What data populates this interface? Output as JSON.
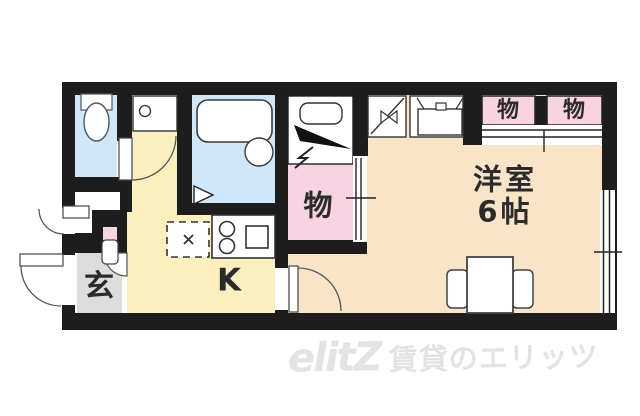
{
  "title": "apartment-floor-plan",
  "labels": {
    "genkan": "玄",
    "kitchen": "K",
    "closet": "物",
    "storage_top_1": "物",
    "storage_top_2": "物",
    "room_name": "洋室",
    "room_size": "6帖"
  },
  "watermark": {
    "logo": "elitZ",
    "text": "賃貸のエリッツ"
  },
  "colors": {
    "wall": "#1d1d1d",
    "water_blue": "#cfe7f8",
    "kitchen_yellow": "#fcefbe",
    "room_cream": "#f9e4c8",
    "storage_pink": "#f8d3e2",
    "entrance_gray": "#dcdcdc",
    "watermark_gray": "#e3e3e3",
    "white": "#ffffff"
  }
}
